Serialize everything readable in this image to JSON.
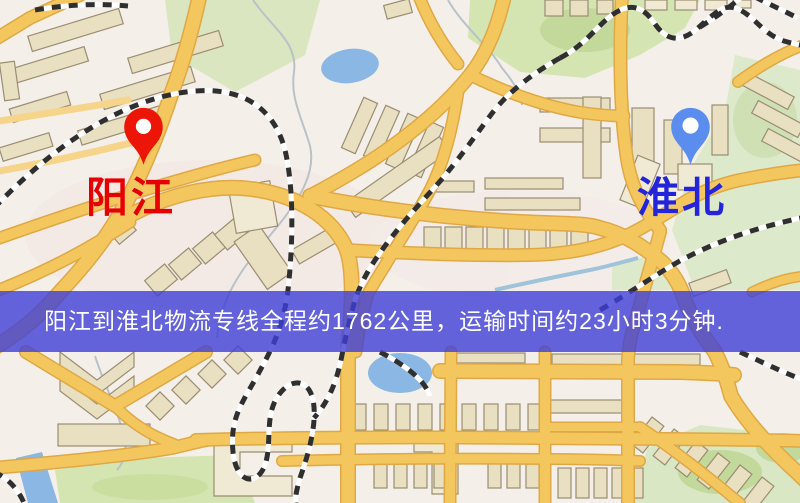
{
  "banner": {
    "text": "阳江到淮北物流专线全程约1762公里，运输时间约23小时3分钟.",
    "background_color": "rgba(62,62,215,0.8)",
    "text_color": "#ffffff",
    "distance_km": "1762",
    "duration": "23小时3分钟"
  },
  "markers": {
    "origin": {
      "label": "阳江",
      "label_color": "#e60000",
      "pin_color": "#ed1507"
    },
    "destination": {
      "label": "淮北",
      "label_color": "#2424d8",
      "pin_color": "#5b8def"
    }
  },
  "map": {
    "colors": {
      "background": "#f4f0e9",
      "road": "#f4c75e",
      "road_casing": "#dfa845",
      "road_minor": "#f6d489",
      "building": "#e9dfc1",
      "building_light": "#f0e9d3",
      "building_border": "#9a8d72",
      "green": "#d5e5b2",
      "green_dark": "#c3d99b",
      "green_pale": "#dde9cb",
      "water": "#8ab7e3",
      "railway": "#2f2f2f",
      "stream": "#b9c2c9"
    }
  }
}
